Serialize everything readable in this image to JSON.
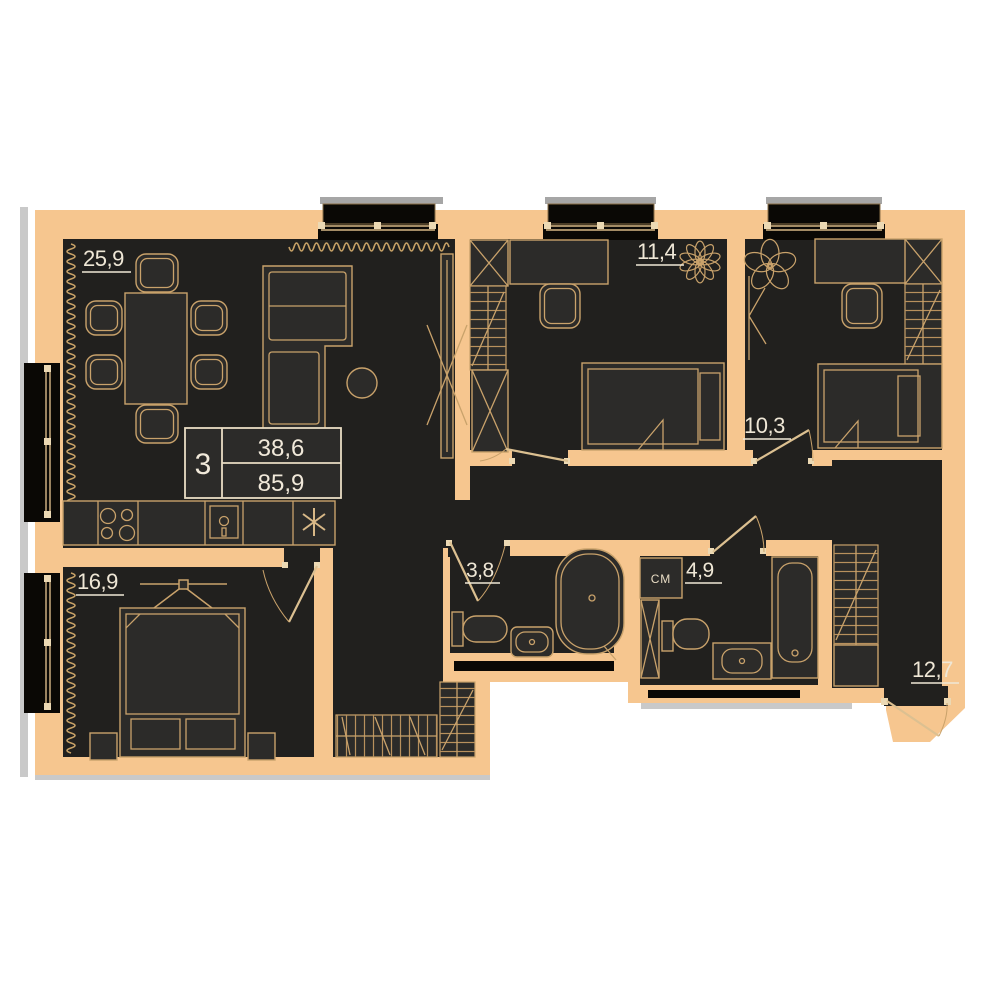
{
  "plan_title": "3-room apartment floor plan",
  "info_box": {
    "rooms_count": "3",
    "living_area": "38,6",
    "total_area": "85,9"
  },
  "room_labels": {
    "living": "25,9",
    "bedroom_top_middle": "11,4",
    "bedroom_top_right": "10,3",
    "bedroom_bottom_left": "16,9",
    "bathroom_small": "3,8",
    "bathroom_large": "4,9",
    "hall": "12,7"
  },
  "annotations": {
    "washing_machine_label": "СМ",
    "kitchen_star_icon": "asterisk",
    "plant_icons": 2
  },
  "colors": {
    "wall_peach": "#f6c68f",
    "floor_dark": "#21201e",
    "furniture_fill": "#2c2b29",
    "outline_tan": "#c9a26b",
    "label_cream": "#efe7d6",
    "exterior_black": "#0a0805",
    "shadow_gray": "#b9b9b9"
  }
}
